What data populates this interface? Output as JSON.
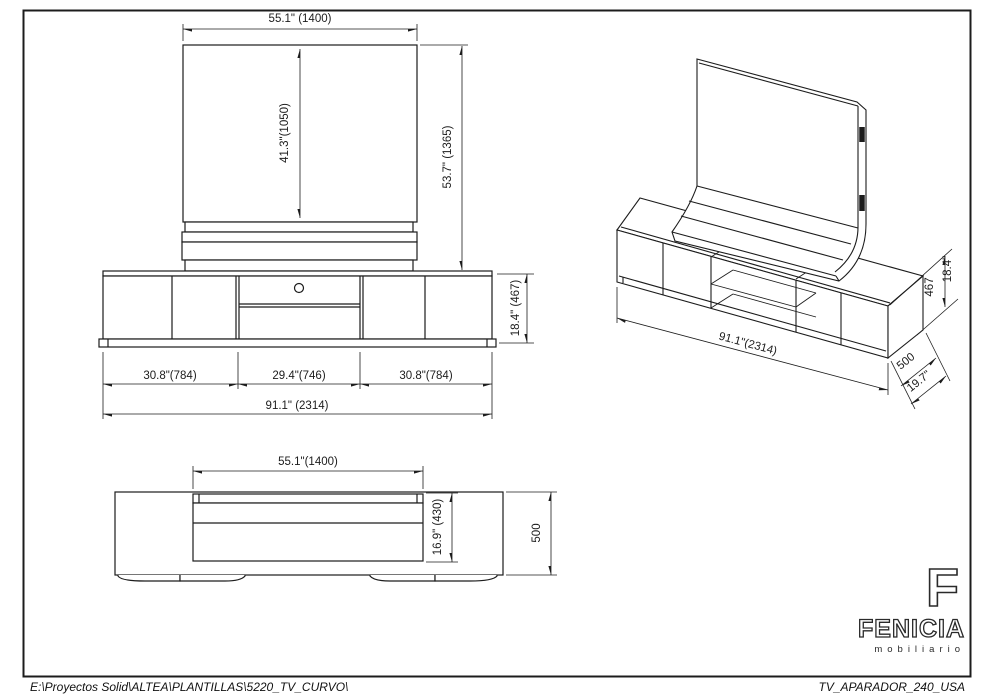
{
  "title_block": {
    "file_path": "E:\\Proyectos Solid\\ALTEA\\PLANTILLAS\\5220_TV_CURVO\\",
    "drawing_name": "TV_APARADOR_240_USA"
  },
  "logo": {
    "mark": "F",
    "brand": "FENICIA",
    "tagline": "mobiliario"
  },
  "views": {
    "front": {
      "dims": {
        "panel_width": "55.1\" (1400)",
        "panel_height": "41.3\"(1050)",
        "overall_height": "53.7\"  (1365)",
        "cabinet_height": "18.4\" (467)",
        "left_section": "30.8\"(784)",
        "center_section": "29.4\"(746)",
        "right_section": "30.8\"(784)",
        "overall_width": "91.1\" (2314)"
      }
    },
    "isometric": {
      "dims": {
        "overall_width": "91.1\"(2314)",
        "depth_mm": "500",
        "depth_in": "19.7\"",
        "height_mm": "467",
        "height_in": "18.4\""
      }
    },
    "top": {
      "dims": {
        "panel_width": "55.1\"(1400)",
        "panel_depth": "16.9\" (430)",
        "overall_depth": "500"
      }
    }
  }
}
